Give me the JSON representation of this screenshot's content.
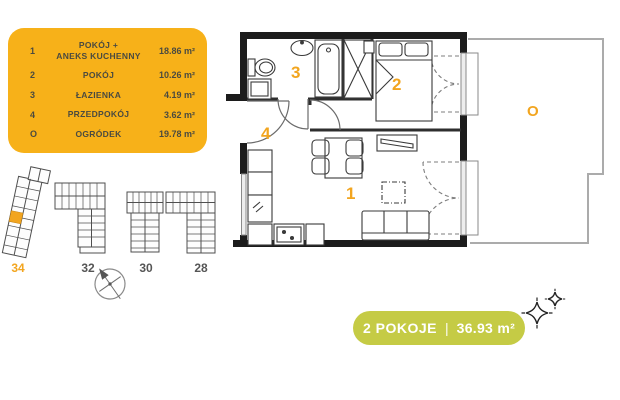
{
  "legend": {
    "rows": [
      {
        "num": "1",
        "name": "POKÓJ +\nANEKS KUCHENNY",
        "area": "18.86 m²"
      },
      {
        "num": "2",
        "name": "POKÓJ",
        "area": "10.26 m²"
      },
      {
        "num": "3",
        "name": "ŁAZIENKA",
        "area": "4.19 m²"
      },
      {
        "num": "4",
        "name": "PRZEDPOKÓJ",
        "area": "3.62 m²"
      },
      {
        "num": "O",
        "name": "OGRÓDEK",
        "area": "19.78 m²"
      }
    ]
  },
  "plan": {
    "rooms": [
      {
        "label": "1"
      },
      {
        "label": "2"
      },
      {
        "label": "3"
      },
      {
        "label": "4"
      },
      {
        "label": "O"
      }
    ]
  },
  "site": {
    "buildings": [
      {
        "label": "34",
        "active": true
      },
      {
        "label": "32",
        "active": false
      },
      {
        "label": "30",
        "active": false
      },
      {
        "label": "28",
        "active": false
      }
    ]
  },
  "badge": {
    "rooms": "2 POKOJE",
    "separator": "|",
    "area": "36.93 m²"
  },
  "colors": {
    "accent_yellow": "#F7B119",
    "label_orange": "#F2A51F",
    "badge_green": "#C5CB45",
    "text_dark": "#4A4A40",
    "wall_black": "#1C1C1C"
  }
}
